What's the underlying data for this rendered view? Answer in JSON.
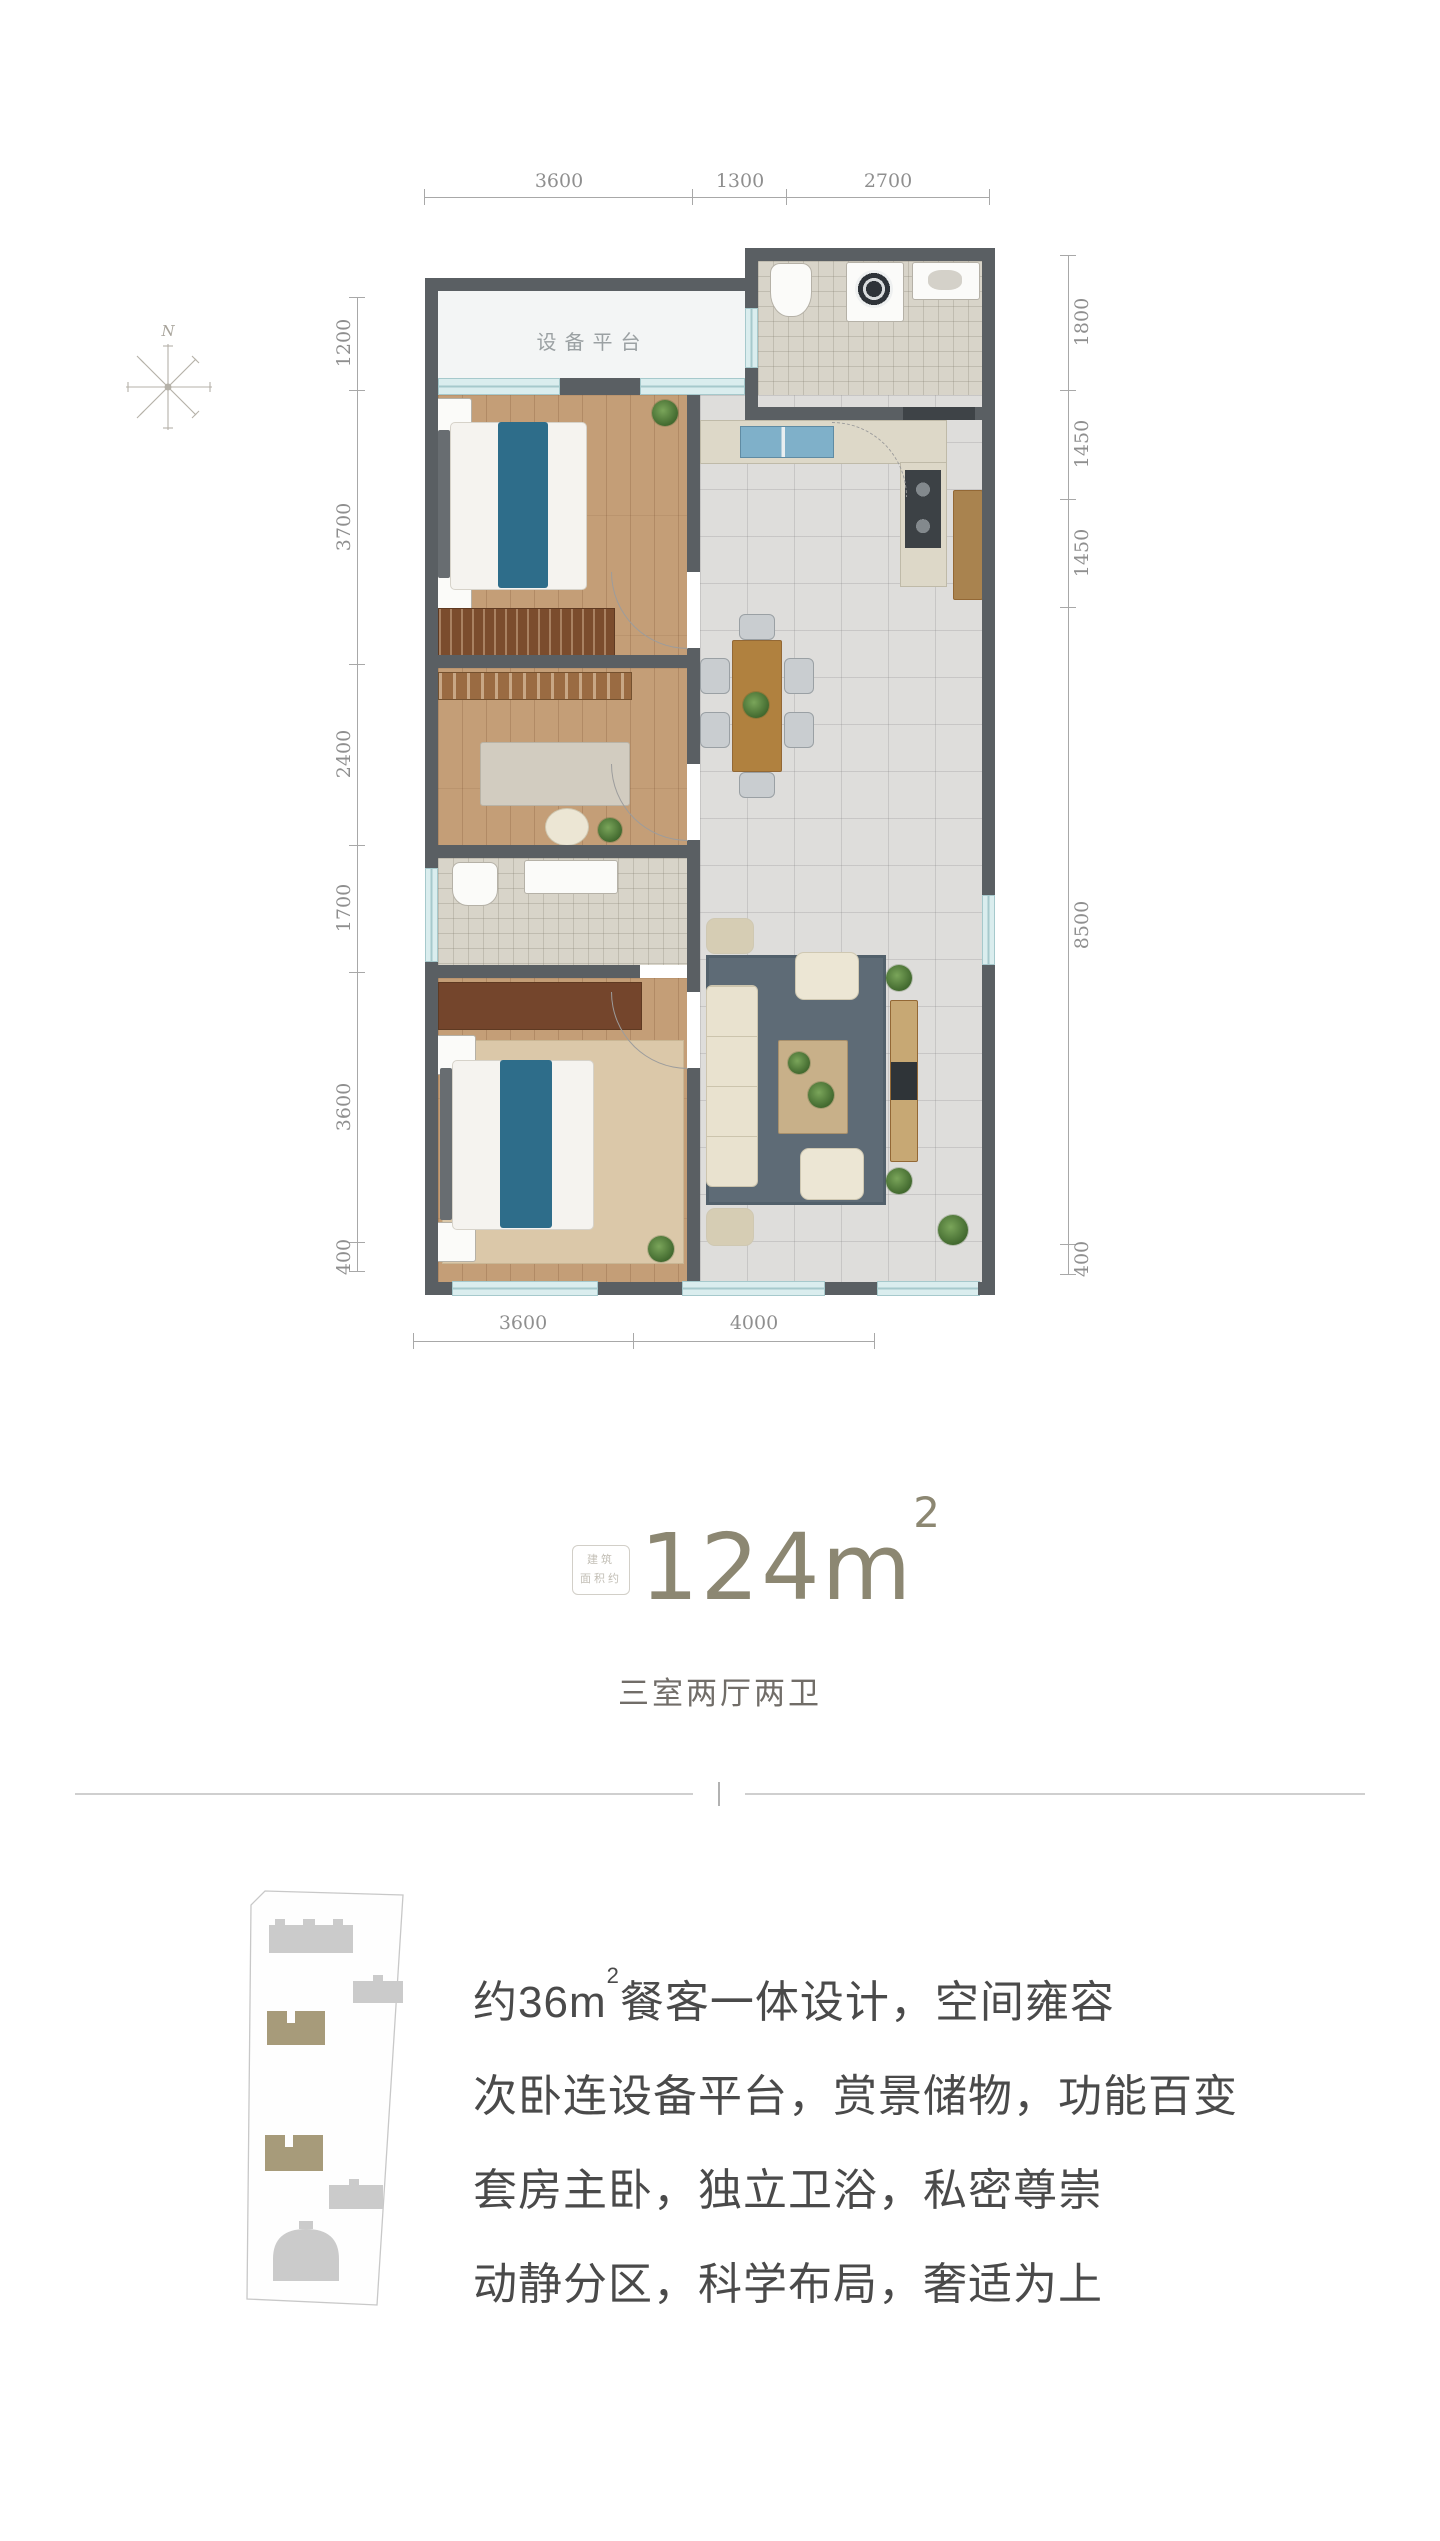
{
  "compass": {
    "north_label": "N"
  },
  "floorplan": {
    "platform_label": "设备平台",
    "dims_top": [
      "3600",
      "1300",
      "2700"
    ],
    "dims_bottom": [
      "3600",
      "4000"
    ],
    "dims_left": [
      "1200",
      "3700",
      "2400",
      "1700",
      "3600",
      "400"
    ],
    "dims_right": [
      "1800",
      "1450",
      "1450",
      "8500",
      "400"
    ]
  },
  "area_badge": {
    "stamp_line1": "建筑",
    "stamp_line2": "面积约",
    "number": "124",
    "unit": "m",
    "superscript": "2"
  },
  "layout_type": "三室两厅两卫",
  "features": [
    {
      "prefix": "约36m",
      "superscript": "2",
      "suffix": "餐客一体设计，空间雍容"
    },
    {
      "prefix": "次卧连设备平台，赏景储物，功能百变",
      "superscript": "",
      "suffix": ""
    },
    {
      "prefix": "套房主卧，独立卫浴，私密尊崇",
      "superscript": "",
      "suffix": ""
    },
    {
      "prefix": "动静分区，科学布局，奢适为上",
      "superscript": "",
      "suffix": ""
    }
  ],
  "colors": {
    "accent_text": "#8c8772",
    "feature_text": "#4a4a4a",
    "wall": "#5a5f63",
    "window": "#daedee",
    "bed_blanket": "#2e6d8a",
    "highlight_building": "#a79b7a"
  }
}
